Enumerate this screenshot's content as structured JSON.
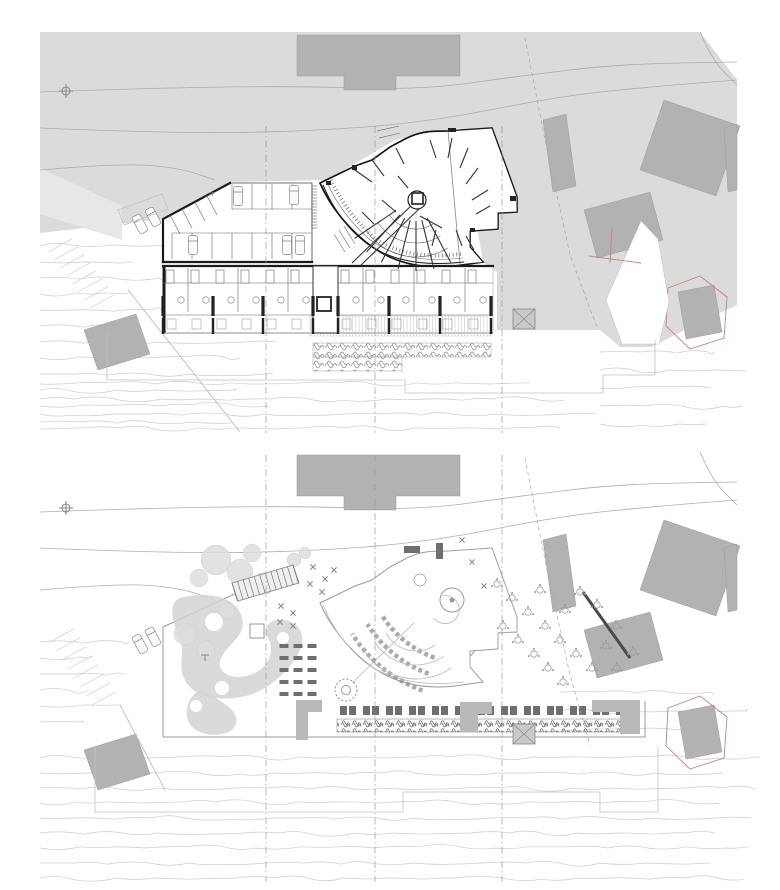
{
  "sheet": {
    "width": 780,
    "height": 890,
    "plans": [
      {
        "id": "upper-floor-plan",
        "dy": 0,
        "guide_y": [
          126,
          433
        ]
      },
      {
        "id": "site-roof-plan",
        "dy": 420,
        "guide_y": [
          455,
          882
        ]
      }
    ]
  },
  "colors": {
    "paper": "#ffffff",
    "terrain": "#dbdbdb",
    "terrainLight": "#e7e7e7",
    "context": "#b2b2b2",
    "contextEdge": "#9d9d9d",
    "red": "#c9807f",
    "road": "#adadad",
    "contour": "#cccccc",
    "wall": "#1b1b1b",
    "faint": "#c3c3c3",
    "deck": "#c8c8c8",
    "shrub": "#8a8a8a",
    "furn": "#6f6f6f",
    "canopy": "#dedede",
    "pathfill": "#d3d3d3",
    "guide": "#9a9a9a"
  },
  "shared": {
    "context_buildings": [
      {
        "name": "north-building",
        "points": [
          [
            297,
            35
          ],
          [
            460,
            35
          ],
          [
            460,
            76
          ],
          [
            396,
            76
          ],
          [
            396,
            90
          ],
          [
            344,
            90
          ],
          [
            344,
            76
          ],
          [
            297,
            76
          ]
        ]
      },
      {
        "name": "northeast-building",
        "points": [
          [
            664,
            100
          ],
          [
            740,
            126
          ],
          [
            716,
            196
          ],
          [
            640,
            170
          ]
        ]
      },
      {
        "name": "east-slab-building",
        "points": [
          [
            543,
            120
          ],
          [
            566,
            114
          ],
          [
            576,
            186
          ],
          [
            553,
            192
          ]
        ]
      },
      {
        "name": "east-building",
        "points": [
          [
            584,
            210
          ],
          [
            650,
            192
          ],
          [
            663,
            240
          ],
          [
            597,
            258
          ]
        ]
      },
      {
        "name": "southwest-building",
        "points": [
          [
            84,
            330
          ],
          [
            136,
            314
          ],
          [
            150,
            354
          ],
          [
            98,
            370
          ]
        ]
      },
      {
        "name": "southeast-building",
        "points": [
          [
            678,
            292
          ],
          [
            714,
            285
          ],
          [
            722,
            332
          ],
          [
            686,
            339
          ]
        ]
      },
      {
        "name": "edge-building",
        "points": [
          [
            724,
            128
          ],
          [
            737,
            124
          ],
          [
            737,
            190
          ],
          [
            728,
            192
          ]
        ]
      }
    ],
    "red_outline": [
      [
        668,
        288
      ],
      [
        700,
        276
      ],
      [
        727,
        297
      ],
      [
        724,
        338
      ],
      [
        690,
        349
      ],
      [
        666,
        326
      ]
    ],
    "roads": [
      [
        [
          40,
          92
        ],
        [
          150,
          88
        ],
        [
          300,
          86
        ],
        [
          420,
          90
        ],
        [
          520,
          76
        ],
        [
          620,
          64
        ],
        [
          737,
          62
        ]
      ],
      [
        [
          40,
          128
        ],
        [
          160,
          133
        ],
        [
          300,
          132
        ],
        [
          430,
          122
        ],
        [
          560,
          96
        ],
        [
          660,
          86
        ],
        [
          737,
          80
        ]
      ],
      [
        [
          40,
          170
        ],
        [
          120,
          163
        ],
        [
          180,
          168
        ],
        [
          215,
          180
        ]
      ],
      [
        [
          700,
          32
        ],
        [
          712,
          60
        ],
        [
          737,
          85
        ]
      ]
    ],
    "cars_road": [
      {
        "x": 140,
        "y": 224,
        "r": -28
      },
      {
        "x": 153,
        "y": 217,
        "r": -28
      }
    ],
    "survey_marker": {
      "x": 66,
      "y": 91
    },
    "crossed_square": {
      "x": 513,
      "y": 309,
      "w": 22,
      "h": 20
    },
    "guide_xs": [
      266,
      375,
      502
    ]
  },
  "upper_plan": {
    "parking": {
      "rows": [
        {
          "x0": 232,
          "x1": 312,
          "step": 20,
          "y0": 184,
          "y1": 209
        },
        {
          "x0": 172,
          "x1": 312,
          "step": 20,
          "y0": 233,
          "y1": 259
        }
      ],
      "hatch": {
        "x0": 311,
        "x1": 317,
        "y0": 186,
        "y1": 228,
        "step": 3
      },
      "angled_stalls": [
        [
          170,
          215,
          180,
          234
        ],
        [
          182,
          209,
          192,
          228
        ],
        [
          195,
          202,
          205,
          221
        ],
        [
          207,
          196,
          217,
          215
        ]
      ],
      "cars": [
        [
          238,
          196
        ],
        [
          294,
          195
        ],
        [
          193,
          245
        ],
        [
          287,
          245
        ],
        [
          300,
          245
        ]
      ]
    },
    "rooms": {
      "band": {
        "x0": 163,
        "x1": 493,
        "top": 266,
        "bottom": 333
      },
      "tick_xs": [
        163,
        213,
        263,
        313,
        338,
        389,
        440,
        491
      ],
      "partition_xs": [
        188,
        238,
        288,
        363,
        414,
        465
      ],
      "room_centers": [
        176,
        201,
        226,
        251,
        276,
        301,
        351,
        376,
        401,
        427,
        452,
        478
      ]
    },
    "fan": {
      "cx": 416,
      "cy": 197,
      "arc_radii": [
        32,
        46,
        60
      ],
      "a0": 58,
      "a1": 146,
      "radial_angles": [
        62,
        76,
        90,
        104,
        118,
        132,
        146
      ],
      "r_in": 24,
      "r_out": 74,
      "walls": [
        [
          352,
          168,
          372,
          182
        ],
        [
          372,
          160,
          384,
          176
        ],
        [
          396,
          148,
          404,
          164
        ],
        [
          430,
          140,
          436,
          158
        ],
        [
          452,
          138,
          448,
          158
        ],
        [
          468,
          148,
          460,
          168
        ],
        [
          478,
          168,
          466,
          184
        ],
        [
          488,
          190,
          472,
          200
        ],
        [
          420,
          216,
          442,
          228
        ],
        [
          436,
          230,
          432,
          246
        ],
        [
          456,
          230,
          462,
          246
        ],
        [
          398,
          176,
          408,
          188
        ],
        [
          382,
          200,
          396,
          212
        ],
        [
          362,
          212,
          374,
          224
        ],
        [
          490,
          206,
          476,
          214
        ],
        [
          466,
          236,
          474,
          250
        ]
      ],
      "poche": [
        [
          448,
          128,
          8,
          4
        ],
        [
          510,
          196,
          6,
          5
        ],
        [
          470,
          228,
          5,
          4
        ],
        [
          352,
          165,
          5,
          5
        ],
        [
          326,
          181,
          5,
          4
        ]
      ]
    },
    "shrub_rows": [
      [
        313,
        343,
        178,
        14
      ],
      [
        313,
        357,
        89,
        14
      ]
    ],
    "steps_strip": {
      "x": 48,
      "y": 252,
      "dx": 6,
      "dyy": 8,
      "len": 24,
      "count": 8
    },
    "contours": [
      {
        "y0": 246,
        "step": 16,
        "count": 6,
        "x0": 40,
        "x1": 170
      },
      {
        "y0": 342,
        "step": 16,
        "count": 6,
        "x0": 40,
        "x1": 300
      },
      {
        "y0": 352,
        "step": 18,
        "count": 5,
        "x0": 600,
        "x1": 760
      },
      {
        "y0": 384,
        "step": 15,
        "count": 4,
        "x0": 40,
        "x1": 600
      }
    ]
  },
  "lower_plan": {
    "garden": {
      "trees": [
        [
          216,
          560,
          15
        ],
        [
          240,
          572,
          13
        ],
        [
          263,
          584,
          11
        ],
        [
          199,
          578,
          9
        ],
        [
          252,
          553,
          9
        ],
        [
          185,
          634,
          11
        ],
        [
          206,
          650,
          9
        ],
        [
          227,
          611,
          8
        ],
        [
          294,
          560,
          7
        ],
        [
          305,
          553,
          6
        ]
      ],
      "path_holes": [
        [
          214,
          622,
          9
        ],
        [
          247,
          660,
          8
        ],
        [
          222,
          688,
          7
        ],
        [
          283,
          638,
          6
        ],
        [
          196,
          706,
          6
        ]
      ],
      "plant_marks": [
        [
          313,
          567
        ],
        [
          325,
          579
        ],
        [
          334,
          570
        ],
        [
          310,
          584
        ],
        [
          322,
          592
        ],
        [
          281,
          606
        ],
        [
          293,
          613
        ],
        [
          280,
          622
        ],
        [
          293,
          626
        ],
        [
          472,
          562
        ],
        [
          484,
          586
        ],
        [
          462,
          540
        ]
      ],
      "trellis": {
        "p0": [
          232,
          583
        ],
        "p1": [
          293,
          565
        ],
        "count": 11,
        "len": 19
      },
      "picnic": {
        "cols": [
          284,
          298,
          312
        ],
        "rows": [
          646,
          658,
          670,
          682,
          694
        ],
        "w": 9,
        "h": 4
      }
    },
    "round_tables": [
      [
        497,
        584
      ],
      [
        512,
        598
      ],
      [
        528,
        612
      ],
      [
        545,
        626
      ],
      [
        503,
        626
      ],
      [
        518,
        640
      ],
      [
        534,
        654
      ],
      [
        560,
        640
      ],
      [
        576,
        654
      ],
      [
        592,
        668
      ],
      [
        548,
        668
      ],
      [
        563,
        682
      ],
      [
        606,
        646
      ],
      [
        616,
        626
      ],
      [
        597,
        605
      ],
      [
        580,
        592
      ],
      [
        617,
        668
      ],
      [
        633,
        652
      ],
      [
        565,
        610
      ],
      [
        540,
        590
      ]
    ],
    "chair_arcs": {
      "cx": 470,
      "cy": 560,
      "radii": [
        104,
        121,
        139
      ],
      "a0": 110,
      "a1": 148
    },
    "fan": {
      "cx": 416,
      "cy": 617,
      "arc_radii": [
        34,
        48,
        62
      ],
      "a0": 55,
      "a1": 150
    },
    "loungers": {
      "x0": 340,
      "step": 23,
      "count": 13,
      "y": 706
    },
    "shrub_strip": [
      337,
      719,
      301,
      13
    ],
    "steps_strip": {
      "x": 50,
      "y": 642,
      "dx": 6,
      "dyy": 9,
      "len": 24,
      "count": 8
    },
    "contours": [
      {
        "y0": 758,
        "step": 15,
        "count": 9,
        "x0": 40,
        "x1": 760
      },
      {
        "y0": 642,
        "step": 16,
        "count": 6,
        "x0": 40,
        "x1": 152
      },
      {
        "y0": 692,
        "step": 19,
        "count": 3,
        "x0": 560,
        "x1": 760
      }
    ]
  }
}
